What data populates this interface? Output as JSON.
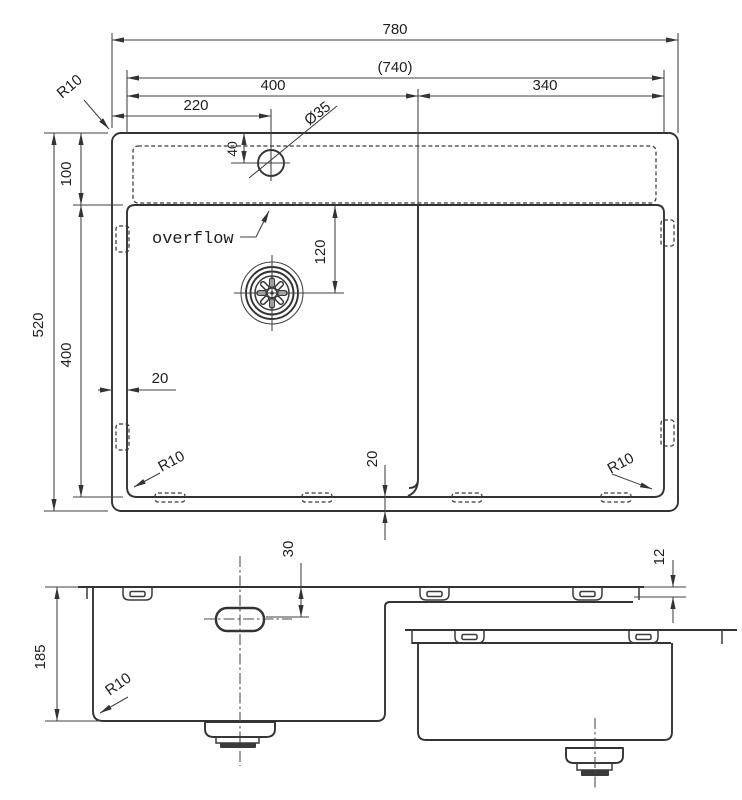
{
  "drawing": {
    "background": "#ffffff",
    "ink": "#333333",
    "top_view": {
      "dims": {
        "overall_width": "780",
        "inner_width": "(740)",
        "left_bowl_width": "400",
        "right_section_width": "340",
        "faucet_offset_x": "220",
        "faucet_hole_diameter": "Ø35",
        "faucet_offset_y": "40",
        "deck_depth": "100",
        "overall_depth": "520",
        "bowl_front_depth": "400",
        "drain_offset": "120",
        "side_gap": "20",
        "bottom_gap": "20",
        "corner_radius_outer": "R10",
        "corner_radius_bowl_left": "R10",
        "corner_radius_bowl_right": "R10"
      },
      "labels": {
        "overflow": "overflow"
      }
    },
    "front_view": {
      "dims": {
        "bowl_depth": "185",
        "faucet_hole_depth": "30",
        "rim_height": "12",
        "corner_radius_bowl": "R10"
      }
    }
  }
}
